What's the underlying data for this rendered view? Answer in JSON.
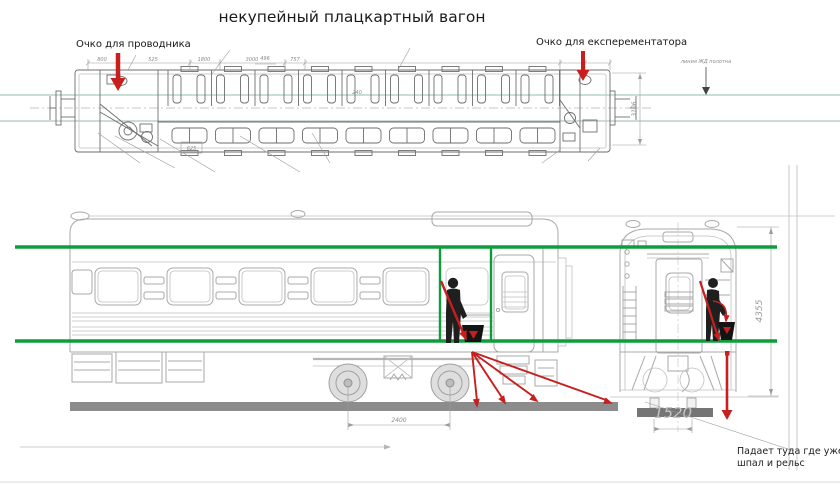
{
  "title": "некупейный плацкартный вагон",
  "annotations": {
    "left_oko": "Очко для проводника",
    "right_oko": "Очко для експерементатора",
    "track_line": "линия ЖД полотна",
    "fall_note_line1": "Падает туда где уже нет",
    "fall_note_line2": "шпал и рельс"
  },
  "dimensions": {
    "plan_top": [
      "800",
      "525",
      "1800",
      "3000",
      "757"
    ],
    "plan_small_a": "496",
    "plan_small_b": "240",
    "plan_boxed": "625",
    "plan_height": "3106",
    "bogie_wheelbase": "2400",
    "car_height": "4355",
    "track_gauge_big": "1520"
  },
  "colors": {
    "accent_red": "#c81e1e",
    "guide_green": "#0f9d3c",
    "guide_teal": "#96beb2",
    "ground_gray": "#8c8c8c"
  }
}
